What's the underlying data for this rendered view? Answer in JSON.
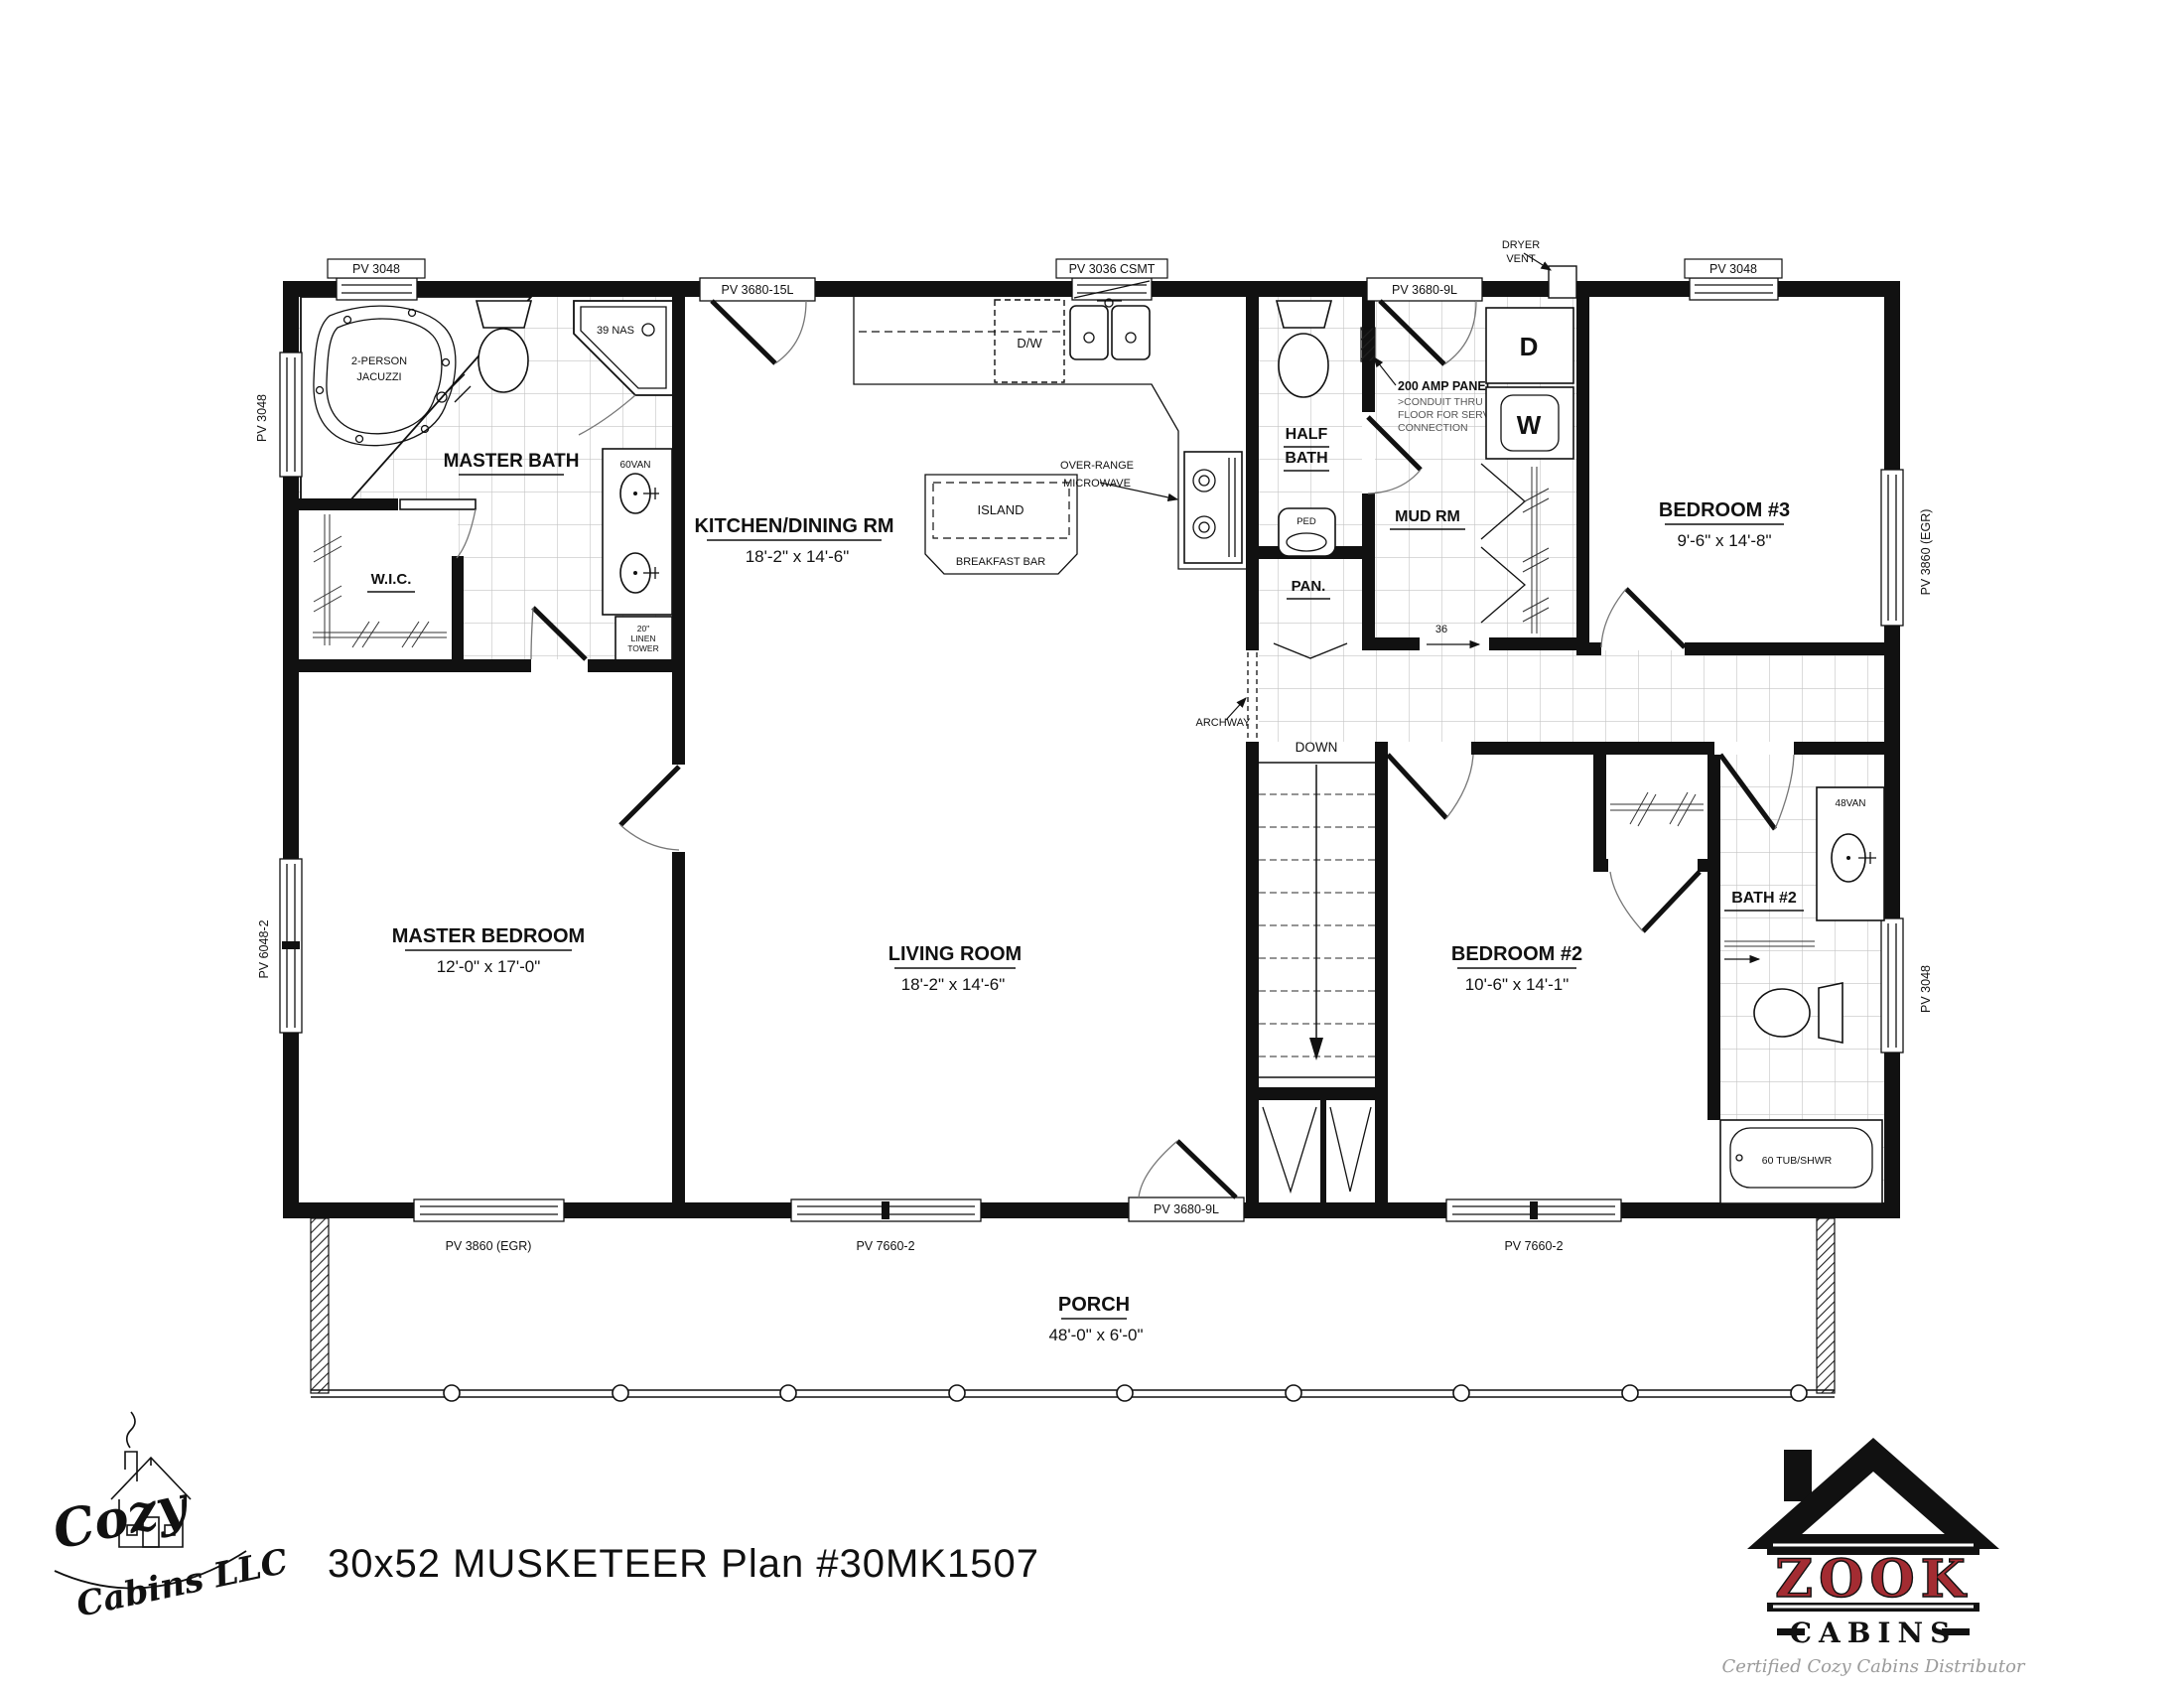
{
  "plan": {
    "title": "30x52 MUSKETEER  Plan #30MK1507"
  },
  "logos": {
    "cozy_line1": "Cozy",
    "cozy_line2": "Cabins LLC",
    "zook_name": "ZOOK",
    "zook_sub": "CABINS",
    "zook_tagline": "Certified Cozy Cabins Distributor"
  },
  "rooms": {
    "master_bath": "MASTER BATH",
    "wic": "W.I.C.",
    "kitchen_name": "KITCHEN/DINING RM",
    "kitchen_dim": "18'-2\" x 14'-6\"",
    "half_bath_1": "HALF",
    "half_bath_2": "BATH",
    "mud_rm": "MUD RM",
    "pan": "PAN.",
    "bedroom3_name": "BEDROOM #3",
    "bedroom3_dim": "9'-6\" x 14'-8\"",
    "master_bedroom_name": "MASTER BEDROOM",
    "master_bedroom_dim": "12'-0\" x 17'-0\"",
    "living_name": "LIVING ROOM",
    "living_dim": "18'-2\" x 14'-6\"",
    "bedroom2_name": "BEDROOM #2",
    "bedroom2_dim": "10'-6\" x 14'-1\"",
    "bath2": "BATH #2",
    "porch_name": "PORCH",
    "porch_dim": "48'-0\" x 6'-0\""
  },
  "fixtures": {
    "jacuzzi_1": "2-PERSON",
    "jacuzzi_2": "JACUZZI",
    "shower": "39 NAS",
    "vanity60": "60VAN",
    "linen_1": "20\"",
    "linen_2": "LINEN",
    "linen_3": "TOWER",
    "dw": "D/W",
    "island": "ISLAND",
    "breakfast_bar": "BREAKFAST BAR",
    "microwave_1": "OVER-RANGE",
    "microwave_2": "MICROWAVE",
    "ped": "PED",
    "dryer": "D",
    "washer": "W",
    "vanity48": "48VAN",
    "tub": "60 TUB/SHWR",
    "down": "DOWN",
    "archway": "ARCHWAY",
    "dryer_vent_1": "DRYER",
    "dryer_vent_2": "VENT",
    "panel_1": "200 AMP PANEL",
    "panel_2": ">CONDUIT THRU",
    "panel_3": "FLOOR FOR SERVICE",
    "panel_4": "CONNECTION",
    "opening36": "36"
  },
  "win": {
    "top_left": "PV 3048",
    "top_kitchen_door": "PV 3680-15L",
    "top_kitchen_win": "PV 3036 CSMT",
    "top_mud_door": "PV 3680-9L",
    "top_bed3": "PV 3048",
    "left_bath": "PV 3048",
    "left_master": "PV 6048-2",
    "right_bed3": "PV 3860 (EGR)",
    "right_bath2": "PV 3048",
    "bot_master": "PV 3860 (EGR)",
    "bot_living": "PV 7660-2",
    "bot_door": "PV 3680-9L",
    "bot_bed2": "PV 7660-2"
  }
}
